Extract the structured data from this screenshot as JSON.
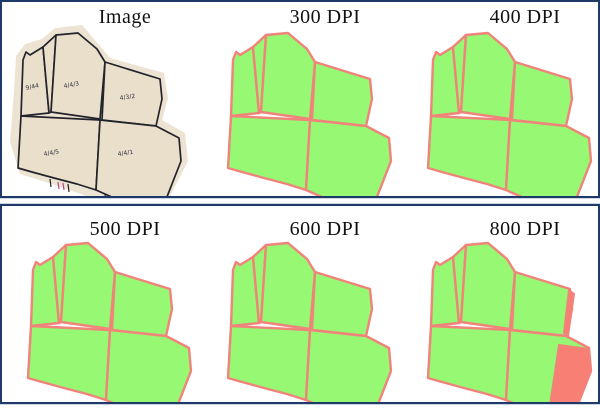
{
  "figure": {
    "rows": [
      {
        "cells": [
          {
            "title": "Image",
            "type": "scanned-source"
          },
          {
            "title": "300 DPI",
            "type": "segmentation"
          },
          {
            "title": "400 DPI",
            "type": "segmentation"
          }
        ]
      },
      {
        "cells": [
          {
            "title": "500 DPI",
            "type": "segmentation"
          },
          {
            "title": "600 DPI",
            "type": "segmentation"
          },
          {
            "title": "800 DPI",
            "type": "segmentation-with-errors"
          }
        ]
      }
    ]
  },
  "scan": {
    "parcel_labels": [
      "9/44",
      "4/4/3",
      "4/3/2",
      "4/4/5",
      "4/4/1"
    ]
  },
  "colors": {
    "background": "#ffffff",
    "box_border": "#1f3a68",
    "title_color": "#111111",
    "map_green": "#97f873",
    "boundary_salmon": "#f0837a",
    "error_red": "#f87f74",
    "paper": "#ece3d2",
    "paper_deep": "#e9dfcb",
    "ink": "#23232b",
    "tick_magenta": "#b84a86"
  }
}
